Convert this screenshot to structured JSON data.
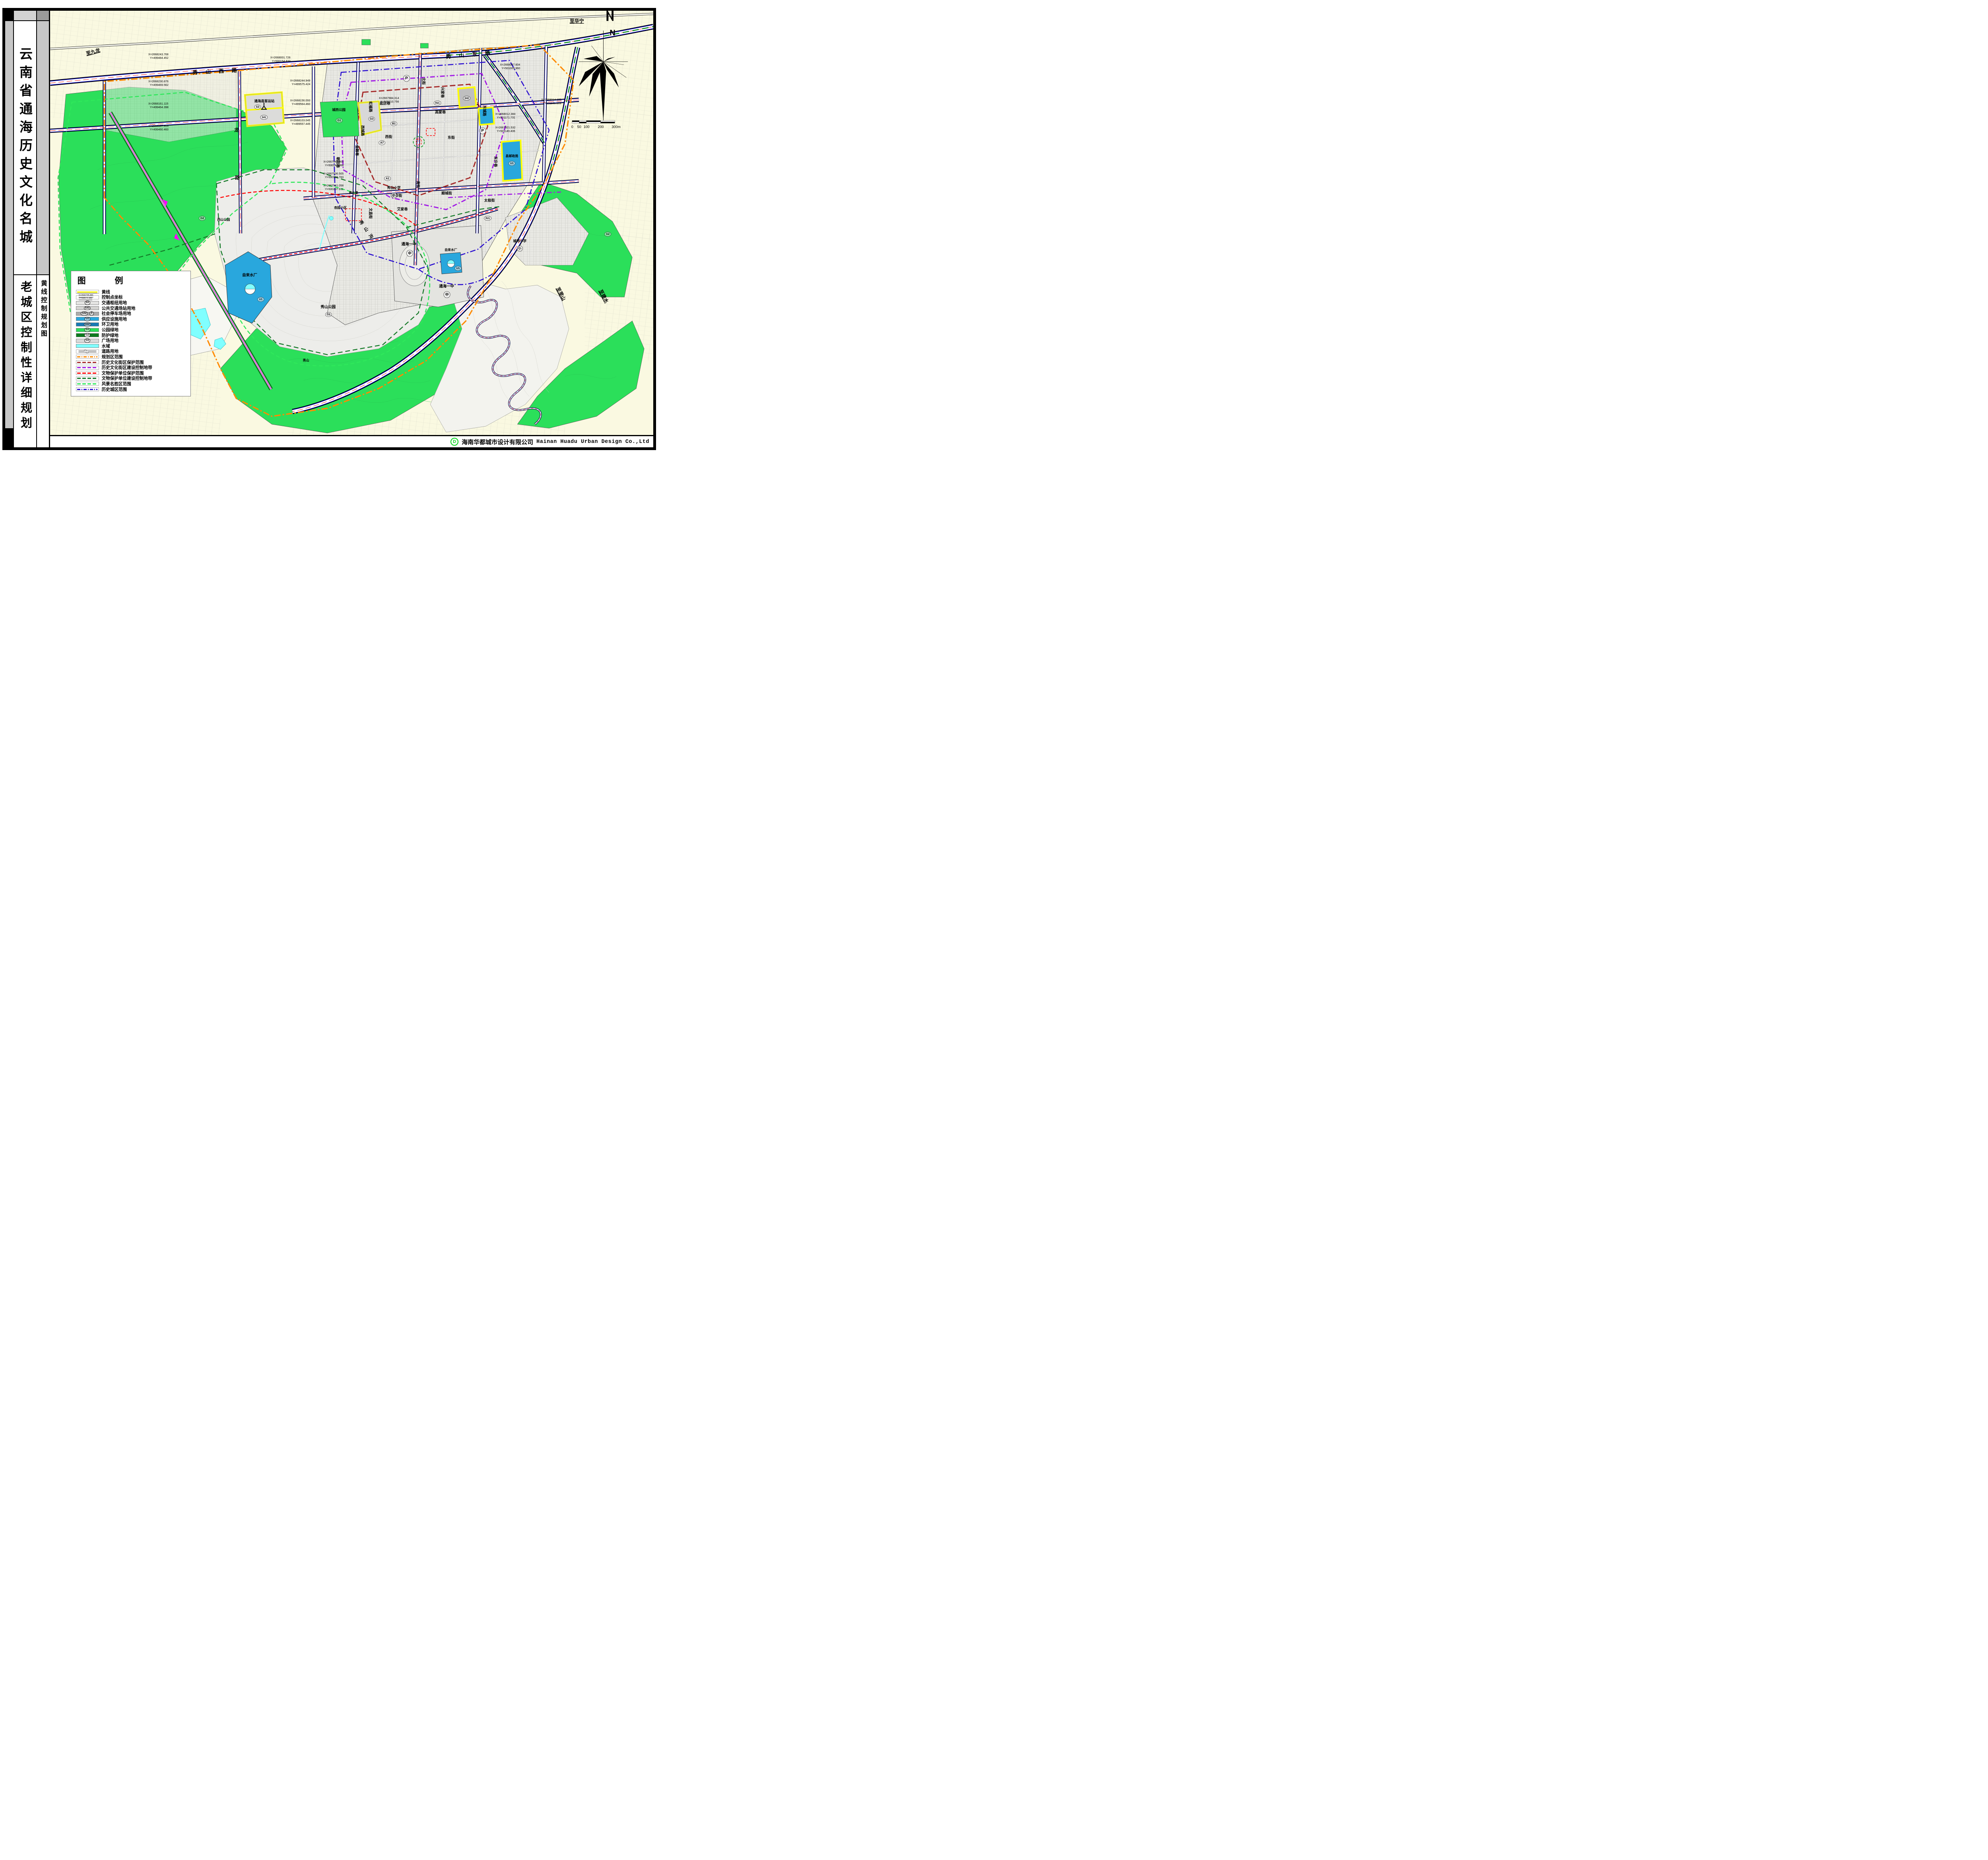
{
  "sidebar": {
    "title_main": "云南省通海历史文化名城",
    "title_sub": "老城区控制性详细规划",
    "map_sheet_title": "黄线控制规划图"
  },
  "legend": {
    "title": "图　例",
    "items": [
      {
        "label": "黄线",
        "kind": "line",
        "color": "#FFFF00"
      },
      {
        "label": "控制点坐标",
        "kind": "coord",
        "x": "X=2666795.881",
        "y": "Y=498570.389"
      },
      {
        "label": "交通枢纽用地",
        "kind": "fill",
        "code": "S3",
        "color": "#E3E3E1"
      },
      {
        "label": "公共交通场站用地",
        "kind": "fill",
        "code": "S41",
        "color": "#D2D2D0"
      },
      {
        "label": "社会停车场用地",
        "kind": "fill",
        "code": "S42",
        "color": "#ABABAB",
        "extra": "P"
      },
      {
        "label": "供应设施用地",
        "kind": "fill",
        "code": "U1",
        "color": "#29A7DD"
      },
      {
        "label": "环卫用地",
        "kind": "fill",
        "code": "U22",
        "color": "#1879B4"
      },
      {
        "label": "公园绿地",
        "kind": "fill",
        "code": "G1",
        "color": "#2BDF5A"
      },
      {
        "label": "防护绿地",
        "kind": "fill",
        "code": "G2",
        "color": "#0C7A1E"
      },
      {
        "label": "广场用地",
        "kind": "fill",
        "code": "G3",
        "color": "#D9D9D9"
      },
      {
        "label": "水域",
        "kind": "fill",
        "code": "",
        "color": "#80FFFF"
      },
      {
        "label": "道路用地",
        "kind": "road",
        "color": "#FFFFFF"
      },
      {
        "label": "规划区范围",
        "kind": "dashdot",
        "color": "#FF8A00"
      },
      {
        "label": "历史文化街区保护范围",
        "kind": "dash",
        "color": "#A52A2A"
      },
      {
        "label": "历史文化街区建设控制地带",
        "kind": "dash",
        "color": "#A21AE6"
      },
      {
        "label": "文物保护单位保护范围",
        "kind": "dash",
        "color": "#FF0000"
      },
      {
        "label": "文物保护单位建设控制地带",
        "kind": "dash",
        "color": "#157A28"
      },
      {
        "label": "风景名胜区范围",
        "kind": "dash",
        "color": "#2FE85B"
      },
      {
        "label": "历史城区范围",
        "kind": "dashdot",
        "color": "#2B0FD0"
      }
    ]
  },
  "footer": {
    "logo": "D",
    "company_cn": "海南华都城市设计有限公司",
    "company_en": "Hainan Huadu Urban Design Co.,Ltd"
  },
  "compass": {
    "label": "N"
  },
  "scalebar": {
    "labels": [
      "0",
      "50",
      "100",
      "200",
      "300m"
    ]
  },
  "map": {
    "edge_labels": [
      {
        "text": "至九龙"
      },
      {
        "text": "至华宁"
      },
      {
        "text": "至里山"
      },
      {
        "text": "至建水"
      }
    ],
    "road_names": [
      {
        "text": "秀山西路"
      },
      {
        "text": "秀山东路"
      },
      {
        "text": "龙"
      },
      {
        "text": "路"
      }
    ],
    "streets": [
      {
        "text": "北街"
      },
      {
        "text": "南街"
      },
      {
        "text": "东街"
      },
      {
        "text": "西街"
      },
      {
        "text": "文昌街"
      },
      {
        "text": "新市街"
      },
      {
        "text": "顺城街"
      },
      {
        "text": "太极街"
      },
      {
        "text": "兴家巷"
      },
      {
        "text": "高家巷"
      },
      {
        "text": "盐店巷"
      },
      {
        "text": "朝阳巷"
      },
      {
        "text": "金融巷"
      },
      {
        "text": "虹福路"
      },
      {
        "text": "东升巷"
      },
      {
        "text": "东城路"
      },
      {
        "text": "西城路"
      },
      {
        "text": "艾家巷"
      }
    ],
    "places": [
      {
        "text": "通海县客运站"
      },
      {
        "text": "城西公园"
      },
      {
        "text": "杏园小区"
      },
      {
        "text": "商业楼"
      },
      {
        "text": "通海一中"
      },
      {
        "text": "通海一中"
      },
      {
        "text": "自来水厂"
      },
      {
        "text": "自来水厂"
      },
      {
        "text": "县邮政局"
      },
      {
        "text": "城郊小学"
      },
      {
        "text": "西山公园"
      },
      {
        "text": "秀山公园"
      },
      {
        "text": "秀山沟"
      },
      {
        "text": "秀山"
      },
      {
        "text": "秀山小学"
      }
    ],
    "badges": [
      {
        "text": "P"
      },
      {
        "text": "P"
      },
      {
        "text": "中"
      },
      {
        "text": "中"
      },
      {
        "text": "小"
      },
      {
        "text": "小"
      },
      {
        "text": "G1"
      },
      {
        "text": "G1"
      },
      {
        "text": "G2"
      },
      {
        "text": "G2"
      },
      {
        "text": "R21"
      },
      {
        "text": "R21"
      },
      {
        "text": "B1"
      },
      {
        "text": "A7"
      },
      {
        "text": "A1"
      },
      {
        "text": "U1"
      },
      {
        "text": "U1"
      },
      {
        "text": "S3"
      },
      {
        "text": "S41"
      },
      {
        "text": "S42"
      },
      {
        "text": "G3"
      },
      {
        "text": "U1"
      }
    ],
    "coordinates": [
      {
        "x": "X=2668243.768",
        "y": "Y=499484.452"
      },
      {
        "x": "X=2668230.876",
        "y": "Y=499469.562"
      },
      {
        "x": "X=2668161.115",
        "y": "Y=499464.398"
      },
      {
        "x": "X=2668107.913",
        "y": "Y=499460.460"
      },
      {
        "x": "X=2668244.949",
        "y": "Y=499575.424"
      },
      {
        "x": "X=2668156.093",
        "y": "Y=499564.460"
      },
      {
        "x": "X=2668103.045",
        "y": "Y=499557.445"
      },
      {
        "x": "X=2667946.000",
        "y": "Y=500147.068"
      },
      {
        "x": "X=2667936.505",
        "y": "Y=500198.783"
      },
      {
        "x": "X=2667941.058",
        "y": "Y=500207.911"
      },
      {
        "x": "X=2668001.726",
        "y": "Y=500154.833"
      },
      {
        "x": "X=2667984.314",
        "y": "Y=500210.756"
      },
      {
        "x": "X=2668067.604",
        "y": "Y=501009.960"
      },
      {
        "x": "X=2668012.384",
        "y": "Y=501171.731"
      },
      {
        "x": "X=2667921.532",
        "y": "Y=501149.406"
      },
      {
        "x": "X=2668014.185",
        "y": "Y=501181.109"
      }
    ]
  }
}
